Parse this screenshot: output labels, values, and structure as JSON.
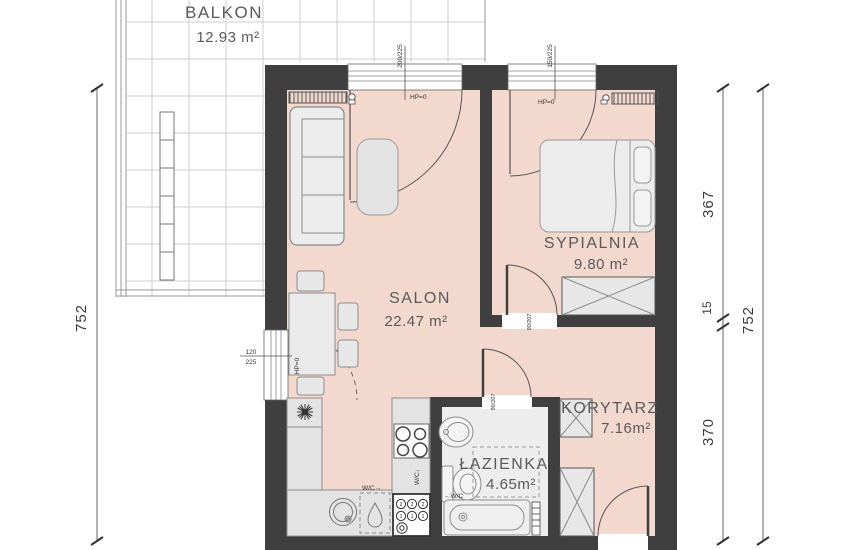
{
  "plan": {
    "rooms": [
      {
        "name": "BALKON",
        "area": "12.93 m²"
      },
      {
        "name": "SALON",
        "area": "22.47 m²"
      },
      {
        "name": "SYPIALNIA",
        "area": "9.80 m²"
      },
      {
        "name": "KORYTARZ",
        "area": "7.16m²"
      },
      {
        "name": "ŁAZIENKA",
        "area": "4.65m²"
      }
    ],
    "dimensions": {
      "left_total": "752",
      "right_top": "367",
      "right_mid": "15",
      "right_bottom": "370",
      "right_total": "752"
    },
    "annotations": {
      "sill_height": "HP=0",
      "window_salon": "200/225",
      "window_bedroom": "150/225",
      "balcony_door_w": "120",
      "balcony_door_h": "225",
      "door_size": "90/207",
      "wc_left": "←W/C",
      "wc_right": "W/C→",
      "wc_down": "W/C↓",
      "washer_row1": "2",
      "washer_row2": "1"
    },
    "colors": {
      "wall": "#3f3f3f",
      "floor": "#f2d8cd",
      "balcony_grid": "#cfcfcf"
    }
  }
}
